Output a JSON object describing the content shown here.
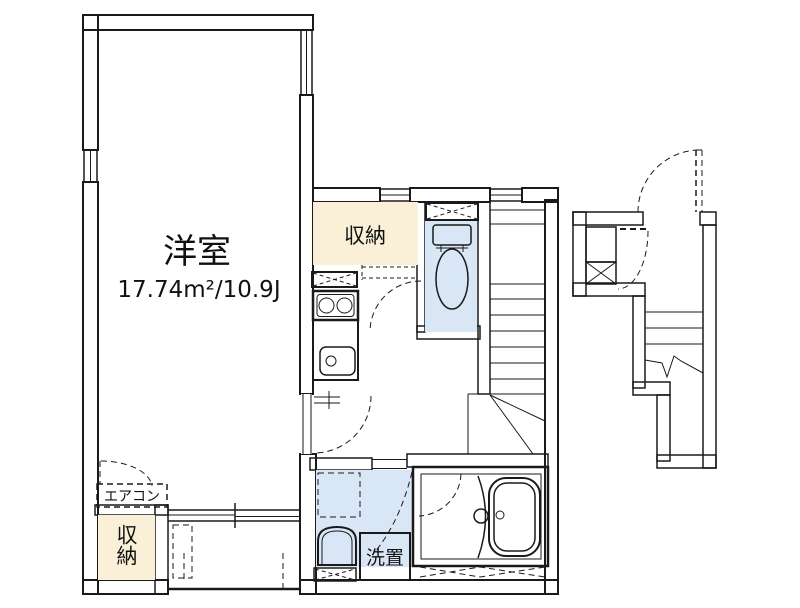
{
  "labels": {
    "main_room_name": "洋室",
    "main_room_area": "17.74m²/10.9J",
    "closet_upper": "収納",
    "closet_lower": "収納",
    "aircon": "エアコン",
    "laundry": "洗置"
  },
  "colors": {
    "wall": "#7d7d7d",
    "line": "#1a1a1a",
    "closet": "#faf0d8",
    "fixture": "#d9e6f5",
    "fixture_light": "#eef4fb",
    "white": "#ffffff",
    "background": "#ffffff"
  },
  "features": [
    "western-room",
    "closet",
    "air-conditioner-position",
    "balcony",
    "kitchen-stove",
    "kitchen-sink",
    "toilet",
    "internal-staircase",
    "washbasin",
    "laundry-space",
    "bathroom-bathtub",
    "entrance-door",
    "shoe-cabinet",
    "external-staircase"
  ]
}
